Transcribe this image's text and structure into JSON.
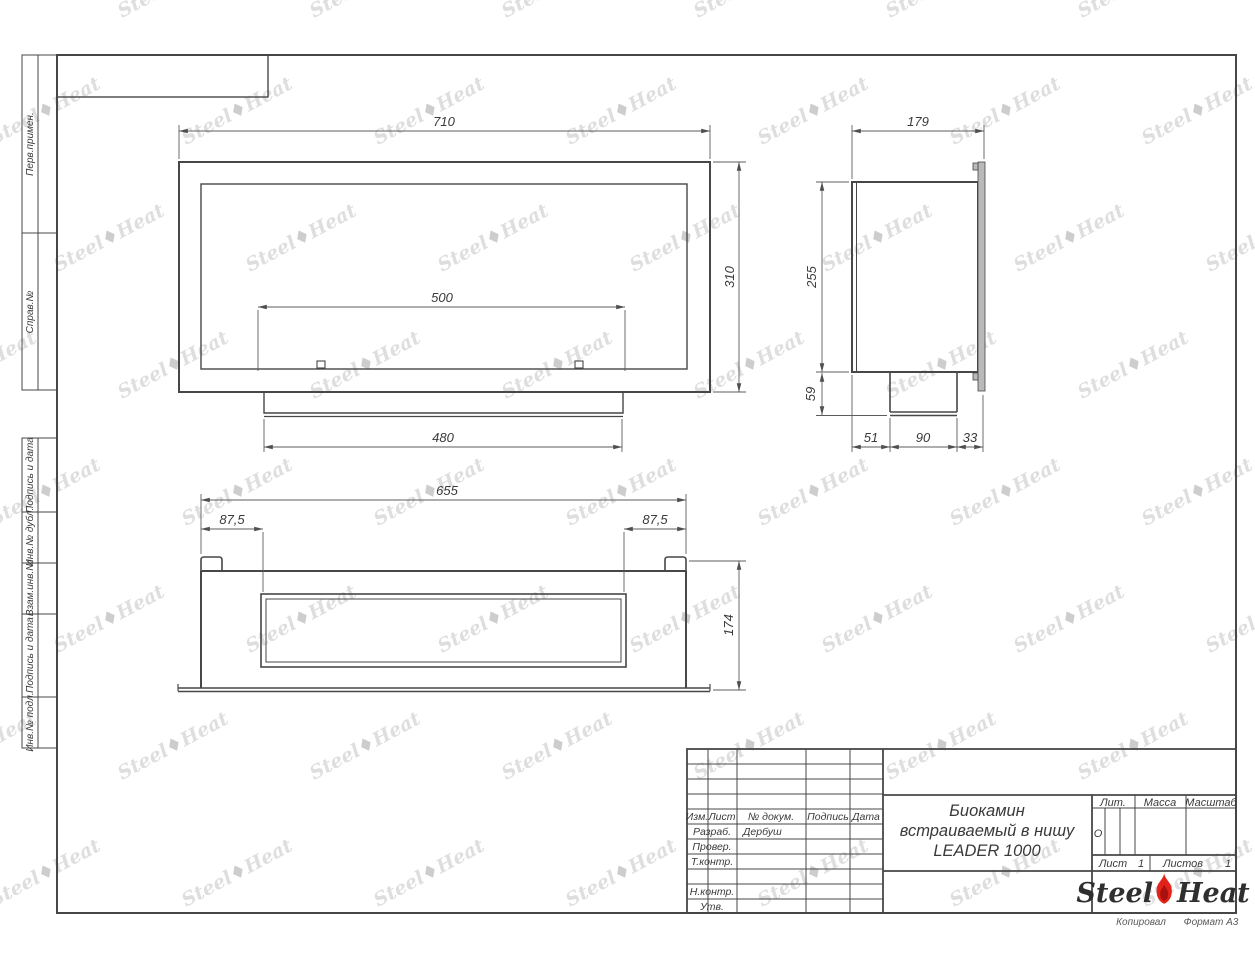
{
  "sheet": {
    "copied_note": "Копировал",
    "format_note": "Формат А3",
    "side_labels": [
      "Перв.примен.",
      "Справ.№",
      "Подпись и дата",
      "Инв.№ дубл.",
      "Взам.инв.№",
      "Подпись и дата",
      "Инв.№ подл."
    ]
  },
  "views": {
    "front": {
      "width": "710",
      "height": "310",
      "opening_width": "500",
      "tray_width": "480"
    },
    "side": {
      "depth": "179",
      "body_height": "255",
      "tray_height": "59",
      "seg1": "51",
      "seg2": "90",
      "seg3": "33"
    },
    "bottom": {
      "width": "655",
      "offset_left": "87,5",
      "offset_right": "87,5",
      "depth": "174"
    }
  },
  "title_block": {
    "header_cols": [
      "Изм.",
      "Лист",
      "№ докум.",
      "Подпись",
      "Дата"
    ],
    "rows": [
      {
        "label": "Разраб.",
        "value": "Дербуш"
      },
      {
        "label": "Провер.",
        "value": ""
      },
      {
        "label": "Т.контр.",
        "value": ""
      },
      {
        "label": "",
        "value": ""
      },
      {
        "label": "Н.контр.",
        "value": ""
      },
      {
        "label": "Утв.",
        "value": ""
      }
    ],
    "doc_title_line1": "Биокамин",
    "doc_title_line2": "встраиваемый в нишу",
    "doc_title_line3": "LEADER 1000",
    "lit_label": "Лит.",
    "lit_value": "О",
    "mass_label": "Масса",
    "scale_label": "Масштаб",
    "sheet_label": "Лист",
    "sheet_value": "1",
    "sheets_label": "Листов",
    "sheets_value": "1",
    "logo": {
      "steel": "Steel",
      "heat": "Heat"
    }
  },
  "colors": {
    "line": "#474747",
    "dim_line": "#5c5c5c",
    "text": "#3a3a3a",
    "flame_red": "#e2231a",
    "flange_fill": "#b9b9b9",
    "watermark": "#dedede"
  }
}
